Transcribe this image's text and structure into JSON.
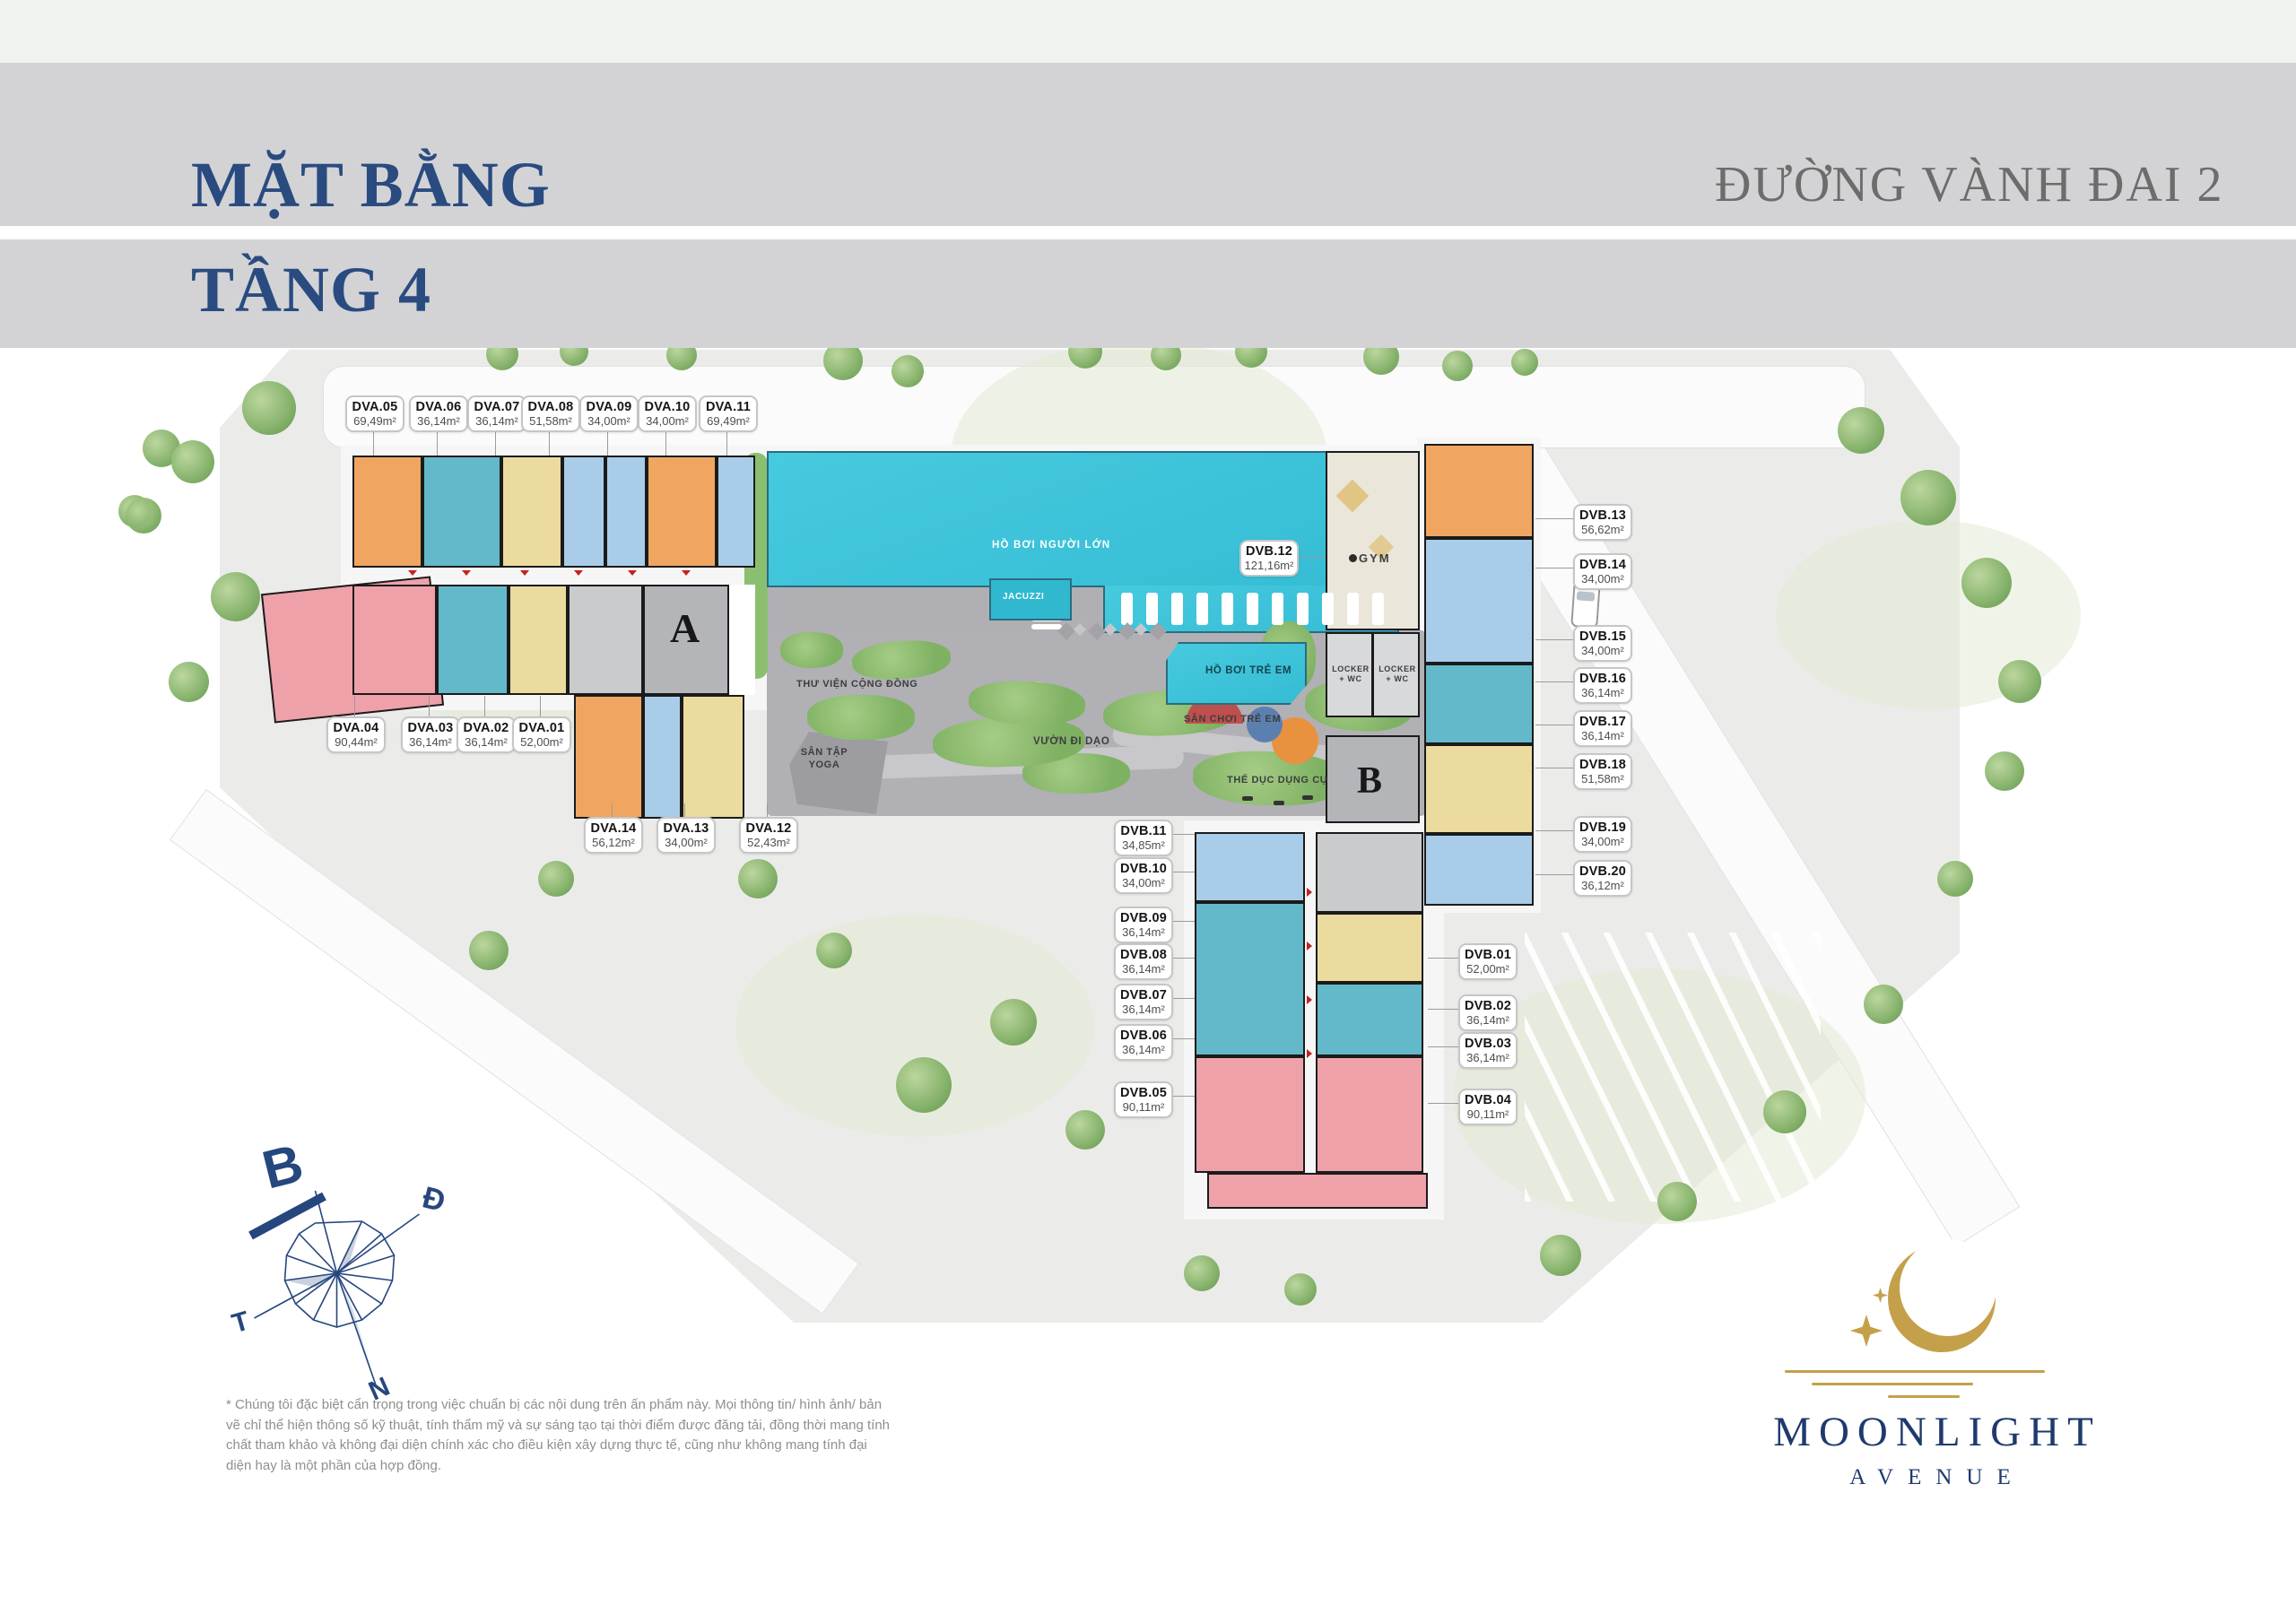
{
  "header": {
    "title_line1": "MẶT BẰNG",
    "title_line2": "TẦNG 4",
    "road_label": "ĐƯỜNG VÀNH ĐAI 2"
  },
  "towers": {
    "a": "A",
    "b": "B"
  },
  "units": {
    "dva01": {
      "name": "DVA.01",
      "area": "52,00m²"
    },
    "dva02": {
      "name": "DVA.02",
      "area": "36,14m²"
    },
    "dva03": {
      "name": "DVA.03",
      "area": "36,14m²"
    },
    "dva04": {
      "name": "DVA.04",
      "area": "90,44m²"
    },
    "dva05": {
      "name": "DVA.05",
      "area": "69,49m²"
    },
    "dva06": {
      "name": "DVA.06",
      "area": "36,14m²"
    },
    "dva07": {
      "name": "DVA.07",
      "area": "36,14m²"
    },
    "dva08": {
      "name": "DVA.08",
      "area": "51,58m²"
    },
    "dva09": {
      "name": "DVA.09",
      "area": "34,00m²"
    },
    "dva10": {
      "name": "DVA.10",
      "area": "34,00m²"
    },
    "dva11": {
      "name": "DVA.11",
      "area": "69,49m²"
    },
    "dva12": {
      "name": "DVA.12",
      "area": "52,43m²"
    },
    "dva13": {
      "name": "DVA.13",
      "area": "34,00m²"
    },
    "dva14": {
      "name": "DVA.14",
      "area": "56,12m²"
    },
    "dvb01": {
      "name": "DVB.01",
      "area": "52,00m²"
    },
    "dvb02": {
      "name": "DVB.02",
      "area": "36,14m²"
    },
    "dvb03": {
      "name": "DVB.03",
      "area": "36,14m²"
    },
    "dvb04": {
      "name": "DVB.04",
      "area": "90,11m²"
    },
    "dvb05": {
      "name": "DVB.05",
      "area": "90,11m²"
    },
    "dvb06": {
      "name": "DVB.06",
      "area": "36,14m²"
    },
    "dvb07": {
      "name": "DVB.07",
      "area": "36,14m²"
    },
    "dvb08": {
      "name": "DVB.08",
      "area": "36,14m²"
    },
    "dvb09": {
      "name": "DVB.09",
      "area": "36,14m²"
    },
    "dvb10": {
      "name": "DVB.10",
      "area": "34,00m²"
    },
    "dvb11": {
      "name": "DVB.11",
      "area": "34,85m²"
    },
    "dvb12": {
      "name": "DVB.12",
      "area": "121,16m²"
    },
    "dvb13": {
      "name": "DVB.13",
      "area": "56,62m²"
    },
    "dvb14": {
      "name": "DVB.14",
      "area": "34,00m²"
    },
    "dvb15": {
      "name": "DVB.15",
      "area": "34,00m²"
    },
    "dvb16": {
      "name": "DVB.16",
      "area": "36,14m²"
    },
    "dvb17": {
      "name": "DVB.17",
      "area": "36,14m²"
    },
    "dvb18": {
      "name": "DVB.18",
      "area": "51,58m²"
    },
    "dvb19": {
      "name": "DVB.19",
      "area": "34,00m²"
    },
    "dvb20": {
      "name": "DVB.20",
      "area": "36,12m²"
    }
  },
  "amenities": {
    "pool_adult": "HỒ BƠI NGƯỜI LỚN",
    "jacuzzi": "JACUZZI",
    "pool_kids": "HỒ BƠI TRẺ EM",
    "playground": "SÂN CHƠI TRẺ EM",
    "gym_equipment": "THỂ DỤC DỤNG CỤ",
    "locker": "LOCKER + WC",
    "library": "THƯ VIỆN CỘNG ĐỒNG",
    "yoga": "SÂN TẬP YOGA",
    "walking_garden": "VƯỜN ĐI DẠO",
    "gym": "GYM"
  },
  "compass": {
    "north_label": "B",
    "east_label": "Đ",
    "west_label": "T",
    "south_label": "N"
  },
  "logo": {
    "brand": "MOONLIGHT",
    "sub": "AVENUE"
  },
  "footer": {
    "disclaimer": "* Chúng tôi đặc biệt cẩn trọng trong việc chuẩn bị các nội dung trên ấn phẩm này. Mọi thông tin/ hình ảnh/ bản vẽ chỉ thể hiện thông số kỹ thuật, tính thẩm mỹ và sự sáng tạo tại thời điểm được đăng tải, đồng thời mang tính chất tham khảo và không đại diện chính xác cho điều kiện xây dựng thực tế, cũng như không mang tính đại diện hay là một phần của hợp đồng."
  },
  "colors": {
    "accent_navy": "#2a4b80",
    "band_gray": "#d3d3d5",
    "road_text_gray": "#6c6c6c",
    "pool_cyan": "#3fc6dc",
    "unit_orange": "#f0a661",
    "unit_teal": "#63b9c9",
    "unit_lightblue": "#a9cde8",
    "unit_yellow": "#ebdb9e",
    "unit_pink": "#efa1aa",
    "core_gray": "#b3b5b9",
    "logo_gold": "#c5a04a"
  }
}
